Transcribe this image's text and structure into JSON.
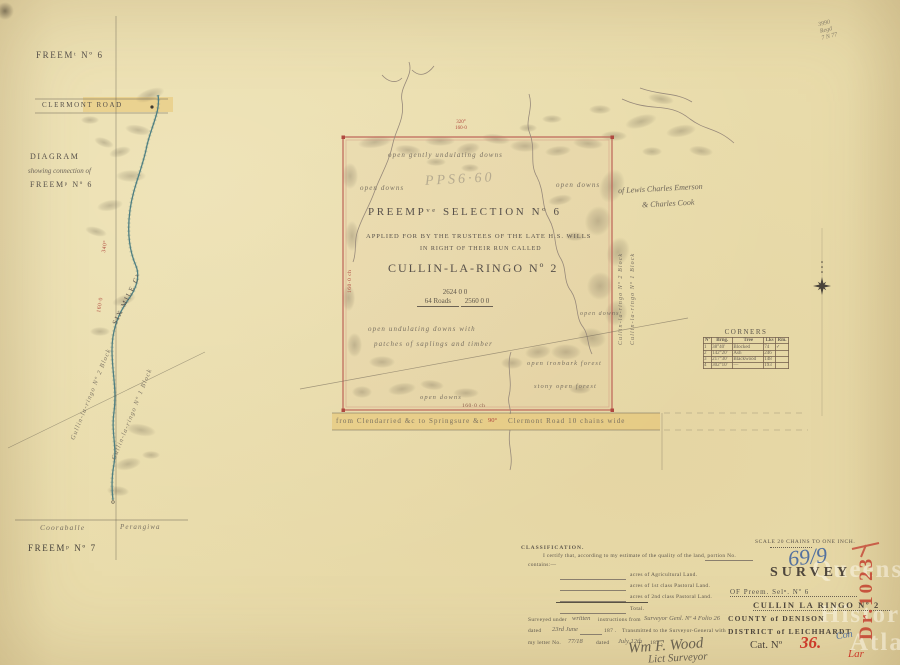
{
  "colors": {
    "paper": "#e9dcab",
    "ink": "#56504a",
    "red_ink": "#b0493f",
    "pink_border": "#bd6357",
    "blue_ink": "#53719f",
    "stamp_red": "#c23b2e",
    "pencil": "#8b8377",
    "highlight": "#e6bf61",
    "creek": "#4e7f82"
  },
  "top_right_note": {
    "line1": "3990",
    "line2": "Regd",
    "line3": "7 N 77"
  },
  "left_diagram": {
    "freemt_no6": "Freemᵗ Nº 6",
    "clermont_road": "Clermont   Road",
    "diagram": "Diagram",
    "showing": "showing connection of",
    "freemp_no6": "Freemᵖ Nº 6",
    "six_mile_creek": "Six Mile Cᵏ",
    "bearing1": "340°",
    "bearing2": "160·0",
    "block2": "Gullin-la-ringo Nº 2 Block",
    "block1": "Gullin-la-ringo Nº 1 Block",
    "cooraballe": "Cooraballe",
    "perangiwa": "Perangiwa",
    "freemp_no7": "Freemᵖ Nº 7"
  },
  "map": {
    "top_bearing": "320°",
    "top_length": "160·0",
    "left_length": "160·0 ch",
    "bottom_length": "160·0 ch",
    "label_open_gently": "open gently undulating downs",
    "label_open_downs_nw": "open downs",
    "label_open_downs_ne": "open downs",
    "pencil_note_faint": "PPS6·60",
    "title_line1": "Preempᵛᵉ Selection Nº 6",
    "title_line2": "Applied for by the Trustees of the late H.S. Wills",
    "title_line3": "in right of their run called",
    "title_line4": "Cullin-la-Ringo Nº 2",
    "area_total": "2624   0   0",
    "area_roads": "64 Roads",
    "area_net": "2560   0   0",
    "label_undulating": "open undulating downs with",
    "label_patches": "patches of saplings and timber",
    "label_open_downs_e": "open downs",
    "label_ironbark": "open ironbark forest",
    "label_stony": "stony open forest",
    "label_open_downs_s": "open downs",
    "edge_label_block2": "Cullin-la-ringo Nº 2 Block",
    "edge_label_block1": "Cullin-la-ringo Nº 1 Block",
    "pencil_note_line1": "of Lewis Charles Emerson",
    "pencil_note_line2": "& Charles Cook"
  },
  "road_band": {
    "left_text": "from Clendarried &c to   Springsure &c",
    "angle": "90°",
    "right_text": "Clermont Road   10 chains wide"
  },
  "corners_table": {
    "title": "Corners",
    "headers": [
      "Nº",
      "Brng.",
      "Tree",
      "Lks",
      "Rm."
    ],
    "rows": [
      [
        "1",
        "38°40'",
        "Blocked",
        "74",
        "✓"
      ],
      [
        "2",
        "142°20'",
        "Ash",
        "246",
        ""
      ],
      [
        "3",
        "217°30'",
        "Blackwood",
        "148",
        ""
      ],
      [
        "4",
        "302°10'",
        "—",
        "193",
        ""
      ]
    ]
  },
  "survey_block": {
    "scale_text": "Scale  20          chains to one inch.",
    "file_no": "69/9",
    "title": "SURVEY",
    "of_line": "OF  Preem. Selⁿ. Nº  6",
    "run_name": "CULLIN LA RINGO Nº 2",
    "county": "COUNTY of DENISON",
    "district": "DISTRICT of LEICHHARDT",
    "cat_label": "Cat. Nº",
    "cat_no": "36.",
    "con": "Con",
    "lar": "Lar",
    "stamp": "Dr.1023"
  },
  "classification": {
    "heading": "CLASSIFICATION.",
    "certify_line": "I certify that, according to my estimate of the quality of the land, portion No.",
    "contains": "contains:—",
    "field1": "acres of Agricultural Land.",
    "field2": "acres of 1st class Pastoral Land.",
    "field3": "acres of 2nd class Pastoral Land.",
    "total": "Total.",
    "surveyed_printed1": "Surveyed under",
    "surveyed_hw1": "written",
    "surveyed_printed2": "instructions from",
    "surveyed_hw2": "Surveyor Genl. Nº 4 Folio 26",
    "dated_printed": "dated",
    "dated_hw": "23rd June",
    "year1": "187 .",
    "transmitted": "Transmitted to the Surveyor-General with",
    "letter_printed": "my letter No.",
    "letter_hw": "77/18",
    "dated2_printed": "dated",
    "dated2_hw": "July 12th",
    "year2": "187 .",
    "signature": "Wm F. Wood",
    "signature_title": "Lict Surveyor"
  },
  "watermark": {
    "line1": "Queensland",
    "line2": "Historical",
    "line3": "Atlas"
  }
}
